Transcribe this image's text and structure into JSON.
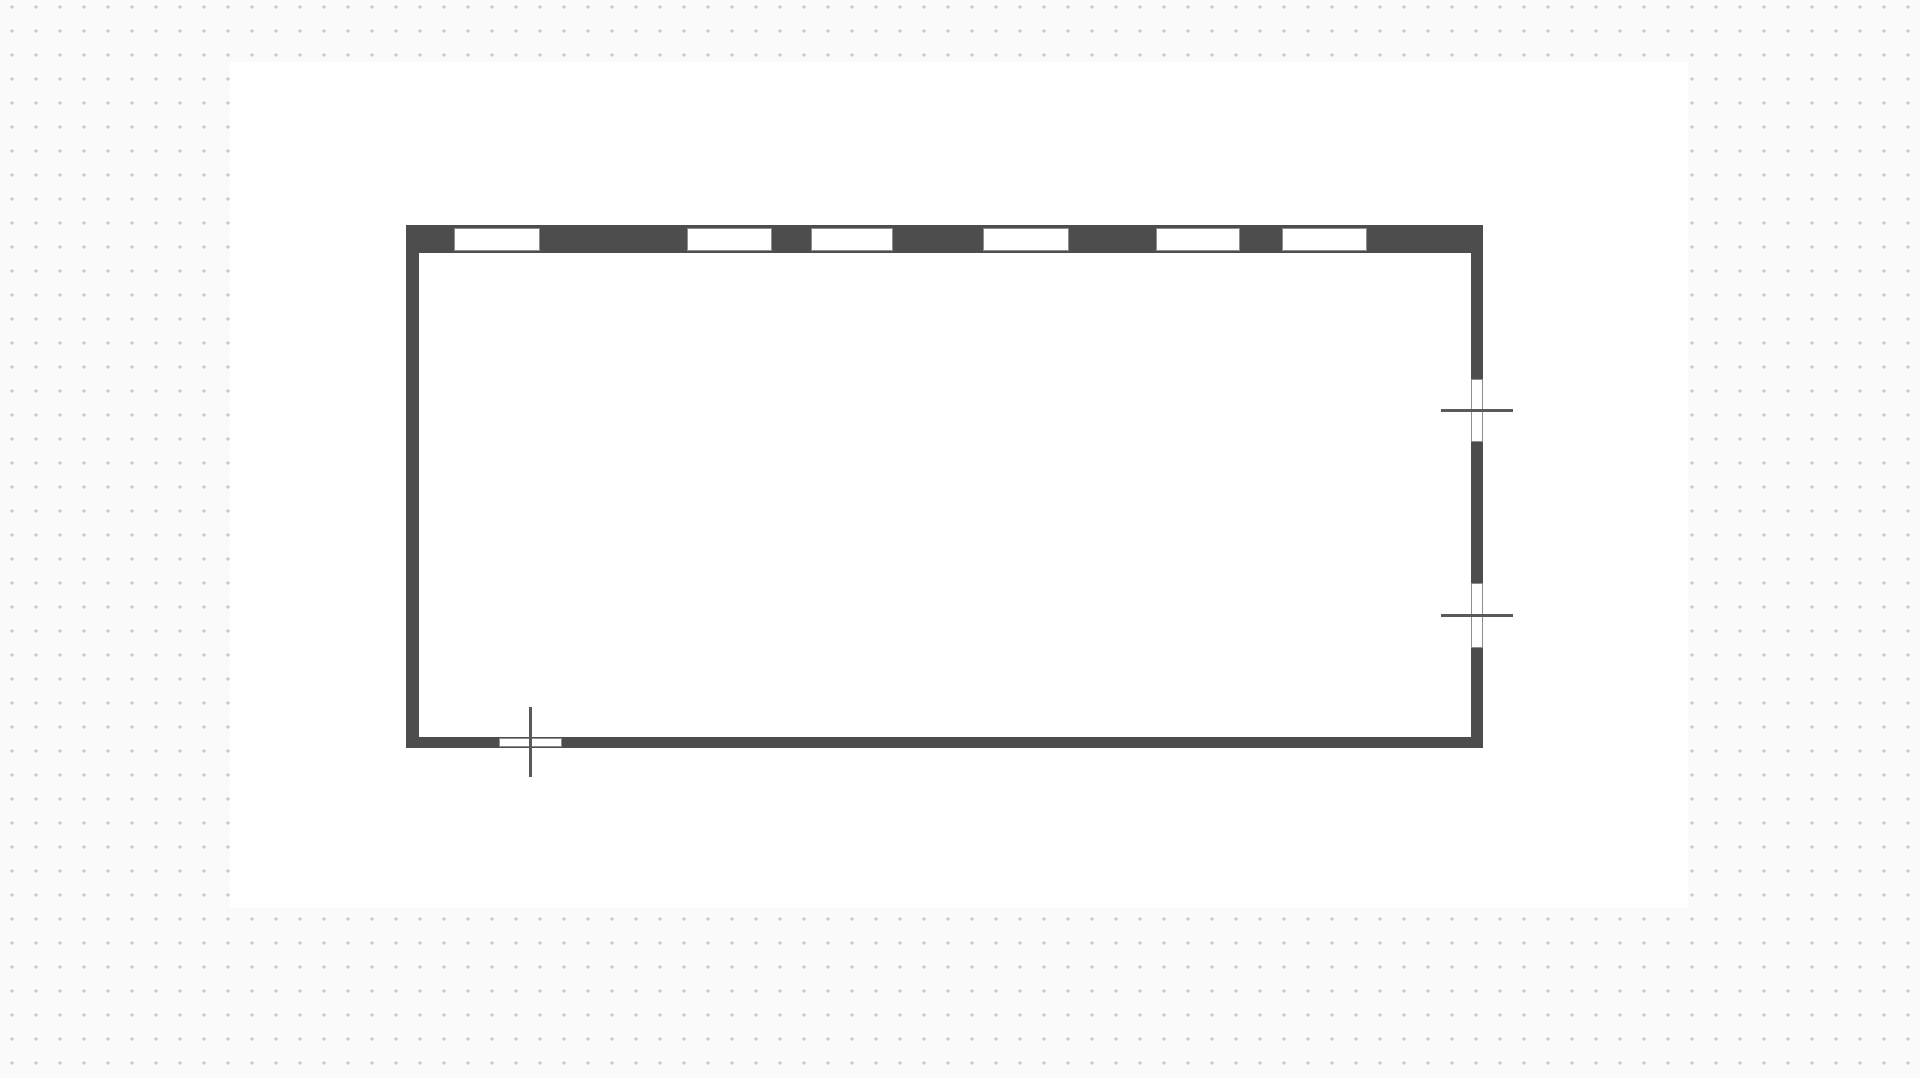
{
  "app": {
    "name": "floor-plan-editor-canvas",
    "view": "empty rectangular room drawn on dotted-grid drafting canvas"
  },
  "colors": {
    "outer_background": "#fafafa",
    "sheet": "#ffffff",
    "grid_dot": "#c7c7c7",
    "wall": "#4d4d4d",
    "window_fill": "#ffffff",
    "window_frame": "#8e8e8e",
    "marker_line": "#5a5a5a"
  },
  "grid": {
    "spacing": 24,
    "offset_x": 12,
    "offset_y": 7,
    "dot_radius": 1.5
  },
  "sheet": {
    "x": 230,
    "y": 62,
    "width": 1458,
    "height": 846
  },
  "room": {
    "outer": {
      "x": 406,
      "y": 225,
      "width": 1077,
      "height": 523
    },
    "wall_thickness": {
      "top": 28,
      "right": 12,
      "bottom": 11,
      "left": 13
    },
    "top_windows": {
      "y": 228,
      "height": 23,
      "items": [
        {
          "x": 454,
          "width": 86
        },
        {
          "x": 687,
          "width": 85
        },
        {
          "x": 811,
          "width": 82
        },
        {
          "x": 983,
          "width": 86
        },
        {
          "x": 1156,
          "width": 84
        },
        {
          "x": 1282,
          "width": 85
        }
      ]
    },
    "right_windows": {
      "x": 1471,
      "width": 12,
      "line_x": 1441,
      "line_length": 72,
      "line_thickness": 3,
      "items": [
        {
          "y": 379,
          "height": 63,
          "line_y": 409
        },
        {
          "y": 583,
          "height": 65,
          "line_y": 614
        }
      ]
    },
    "bottom_windows": {
      "y": 738,
      "height": 9,
      "line_y": 707,
      "line_length": 70,
      "line_thickness": 3,
      "items": [
        {
          "x": 499,
          "width": 63,
          "line_x": 529
        }
      ]
    }
  }
}
